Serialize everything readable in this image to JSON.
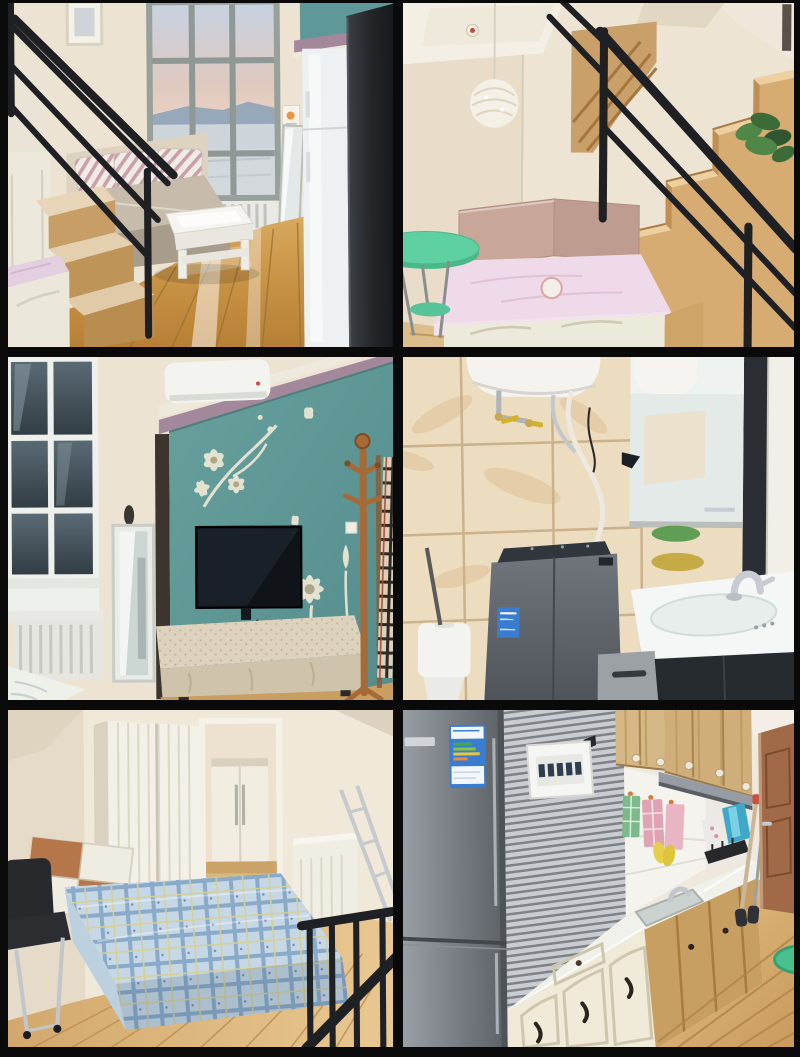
{
  "page": {
    "background": "#0a0a0a"
  },
  "collage": {
    "rows": 3,
    "cols": 2,
    "panels": [
      {
        "id": "loft-living-room",
        "scene": "loft living room with tall window, daybed sofa, white coffee table, wooden stairs with black railing, glossy wood floor"
      },
      {
        "id": "staircase-bed-nook",
        "scene": "wooden staircase with black metal railing, bed nook with pink cover under stairs, mint green round table, wicker pendant lamp, plant on railing"
      },
      {
        "id": "tv-feature-wall",
        "scene": "living room teal feature wall with white floral decal, wall mounted tv, air conditioner, standing mirror, draped tv bench, wooden coat rack with plaid scarf"
      },
      {
        "id": "bathroom-laundry",
        "scene": "bathroom with beige marble tiles, water heater and pipes, mirror cabinet, gray top-load washing machine, white basin with chrome faucet, dark vanity, toilet"
      },
      {
        "id": "bedroom",
        "scene": "bedroom with blue plaid covered double bed, wood and white headboard, white wardrobe, closet doorway, black chair, metal railing, wood floor"
      },
      {
        "id": "kitchen",
        "scene": "kitchen with stainless fridge with blue energy label, striped accent wall, breaker panel, white arched lower cabinets, wood upper cabinets, range hood, hanging towels, wooden door, green stool"
      }
    ]
  },
  "palette": {
    "bg": "#0a0a0a",
    "wallCream": "#ece3d3",
    "wallCreamDark": "#e0d5c1",
    "teal": "#5f9899",
    "mauve": "#a3879a",
    "railBlack": "#1e2024",
    "woodStair": "#d6ac72",
    "woodFloor": "#c89a5c",
    "woodFloorLight": "#e9c892",
    "sofaBeige": "#c7bcab",
    "tableWhite": "#f5f4f0",
    "skyBlue": "#c7d2e0",
    "skyPink": "#e7cfc2",
    "hillBlue": "#8ea3b8",
    "fridgeDark": "#24262a",
    "fridgeSteel": "#767c81",
    "mintTable": "#5fd0a2",
    "bedPink": "#eedae8",
    "padBrown": "#c9a69a",
    "plantGreen": "#3d6b38",
    "tileBeige": "#ecddc1",
    "tileVein": "#dcba8a",
    "washerGray": "#5a6066",
    "sinkWhite": "#f4f7f6",
    "vanityDark": "#262b30",
    "soapGreen": "#5f9e54",
    "soapAmber": "#c2a438",
    "plaidBlue": "#c6d8e6",
    "plaidLine": "#89aac8",
    "headWood": "#b5764a",
    "chairBlack": "#27292d",
    "stripeLight": "#c9ccd0",
    "stripeDark": "#7e8286",
    "labelBlue": "#3a7cd0",
    "cabCream": "#f0ead9",
    "cabWood": "#c89f63",
    "upperWood": "#d6b886",
    "hoodGray": "#979ca2",
    "doorBrown": "#a06a48",
    "towelGreen": "#7cb98b",
    "towelPink": "#dfa4b4",
    "stoolGreen": "#4ac08e"
  }
}
